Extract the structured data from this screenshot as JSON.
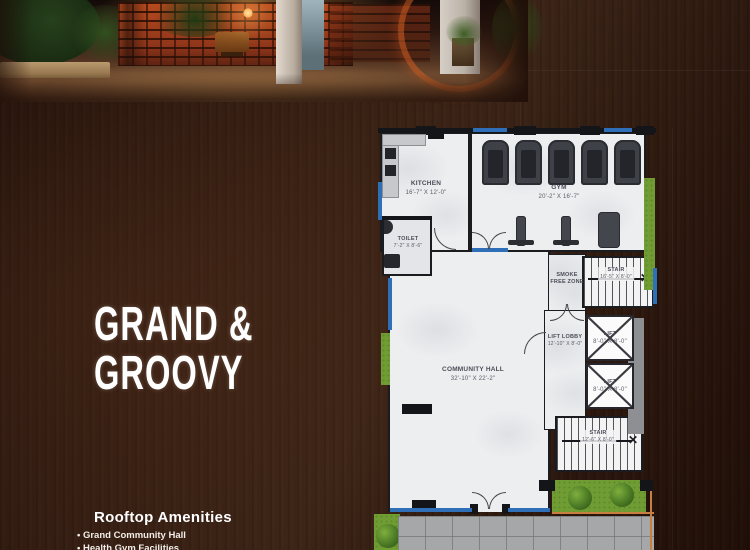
{
  "page": {
    "headline_line1": "GRAND &",
    "headline_line2": "GROOVY",
    "amenities_title": "Rooftop Amenities",
    "amenities": [
      {
        "label": "Grand Community Hall"
      },
      {
        "label": "Health Gym Facilities"
      }
    ]
  },
  "floorplan": {
    "kitchen_name": "KITCHEN",
    "kitchen_dims": "16'-7\" X 12'-0\"",
    "gym_name": "GYM",
    "gym_dims": "20'-2\" X 16'-7\"",
    "toilet_name": "TOILET",
    "toilet_dims": "7'-2\" X 8'-6\"",
    "hall_name": "COMMUNITY HALL",
    "hall_dims": "32'-10\" X 22'-2\"",
    "smoke_line1": "SMOKE",
    "smoke_line2": "FREE ZONE",
    "stair_top_name": "STAIR",
    "stair_top_dims": "16'-5\" X 8'-0\"",
    "stair_bottom_name": "STAIR",
    "stair_bottom_dims": "12'-6\" X 8'-0\"",
    "lobby_name": "LIFT LOBBY",
    "lobby_dims": "12'-10\" X 8'-0\"",
    "lift_name": "LIFT",
    "lift_dims": "8'-0\" X 8'-0\""
  },
  "colors": {
    "accent_blue": "#2f6fb7",
    "lawn_green": "#6f9c33",
    "wall_black": "#141519",
    "terrace_gray": "#a6a7a9",
    "headline_white": "#ffffff",
    "background_wood": "#2a160d"
  }
}
